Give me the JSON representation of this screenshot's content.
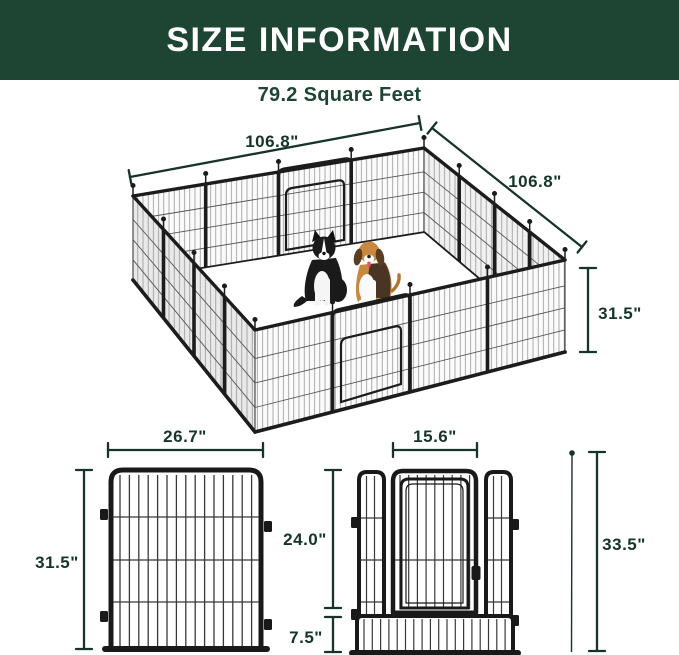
{
  "header": {
    "title": "SIZE INFORMATION"
  },
  "subtitle": "79.2 Square Feet",
  "colors": {
    "header_bg": "#1e4533",
    "dimension_green": "#16342a",
    "fence_frame": "#191919"
  },
  "isometric_diagram": {
    "description": "16-panel metal dog playpen with two gates, isometric view, two dogs sitting inside",
    "top_width_label": "106.8\"",
    "side_width_label": "106.8\"",
    "panel_height_label": "31.5\"",
    "dog_icons": [
      "border-collie",
      "beagle"
    ]
  },
  "regular_panel_diagram": {
    "width_label": "26.7\"",
    "height_label": "31.5\""
  },
  "door_panel_diagram": {
    "door_width_label": "15.6\"",
    "door_height_label": "24.0\"",
    "bottom_section_label": "7.5\"",
    "total_height_label": "33.5\""
  }
}
